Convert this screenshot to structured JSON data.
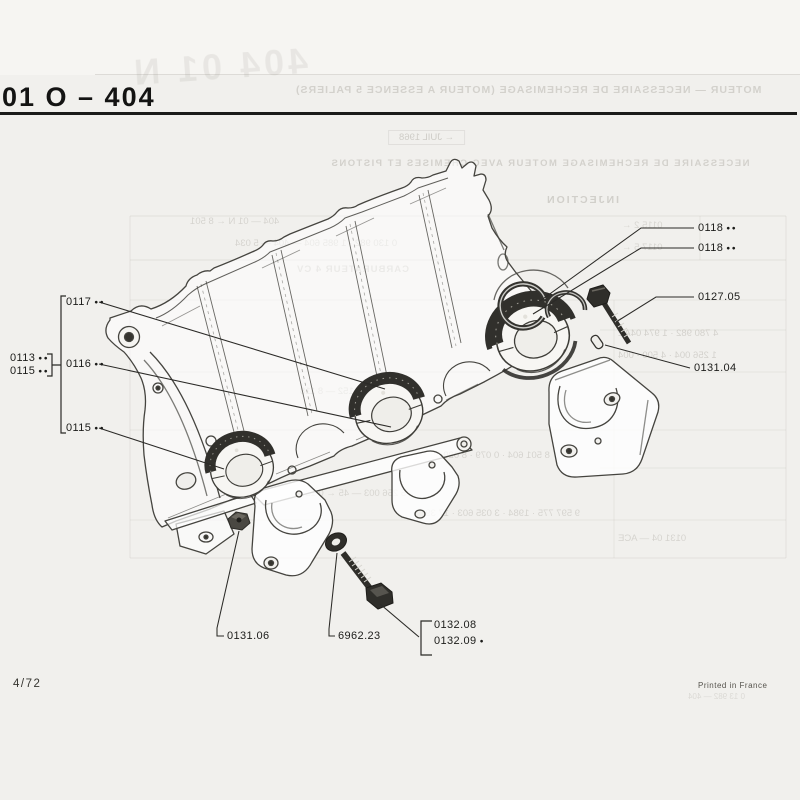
{
  "page": {
    "title": "01 O – 404",
    "footer_left": "4/72",
    "footer_right": "Printed in France"
  },
  "callouts": {
    "group_left_row1": {
      "code": "0113",
      "dots": "●●"
    },
    "group_left_row2": {
      "code": "0115",
      "dots": "●●"
    },
    "c0117": {
      "code": "0117",
      "dots": "●●"
    },
    "c0116": {
      "code": "0116",
      "dots": "●●"
    },
    "c0115": {
      "code": "0115",
      "dots": "●●"
    },
    "c0118_upper": {
      "code": "0118",
      "dots": "●●"
    },
    "c0118_lower": {
      "code": "0118",
      "dots": "●●"
    },
    "c0127_05": {
      "code": "0127.05"
    },
    "c0131_04": {
      "code": "0131.04"
    },
    "c0131_06": {
      "code": "0131.06"
    },
    "c6962_23": {
      "code": "6962.23"
    },
    "c0132_08": {
      "code": "0132.08"
    },
    "c0132_09": {
      "code": "0132.09",
      "dots": "●"
    }
  },
  "ghost": {
    "plate_number": "404 01 N",
    "header": "MOTEUR — NECESSAIRE DE RECHEMISAGE (MOTEUR A ESSENCE 5 PALIERS)",
    "date_box": "← JUIL 1968",
    "subheader": "NECESSAIRE DE RECHEMISAGE MOTEUR AVEC CHEMISES ET PISTONS",
    "section_injection": "INJECTION",
    "section_carburateur": "CARBURATEUR 4 CV",
    "rows": [
      "404 — 01 N ← 8 501",
      "0 130 982 · 1 985 604 — 404 — 5 034",
      "0115 2 ←",
      "0117 5 ←",
      "4 780 982 · 1 974 04AE",
      "1 256 004 · 4 500 · 004",
      "75 034 · 0 880 152 — 8 118",
      "8 501 604 · 0 079 · 8 029 00",
      "5 256 003 — 45 ← 0 127",
      "9 597 775 · 1984 · 3 035 603 · 17 390",
      "0131 04 — ACE",
      "0 13 982 — 404"
    ]
  }
}
